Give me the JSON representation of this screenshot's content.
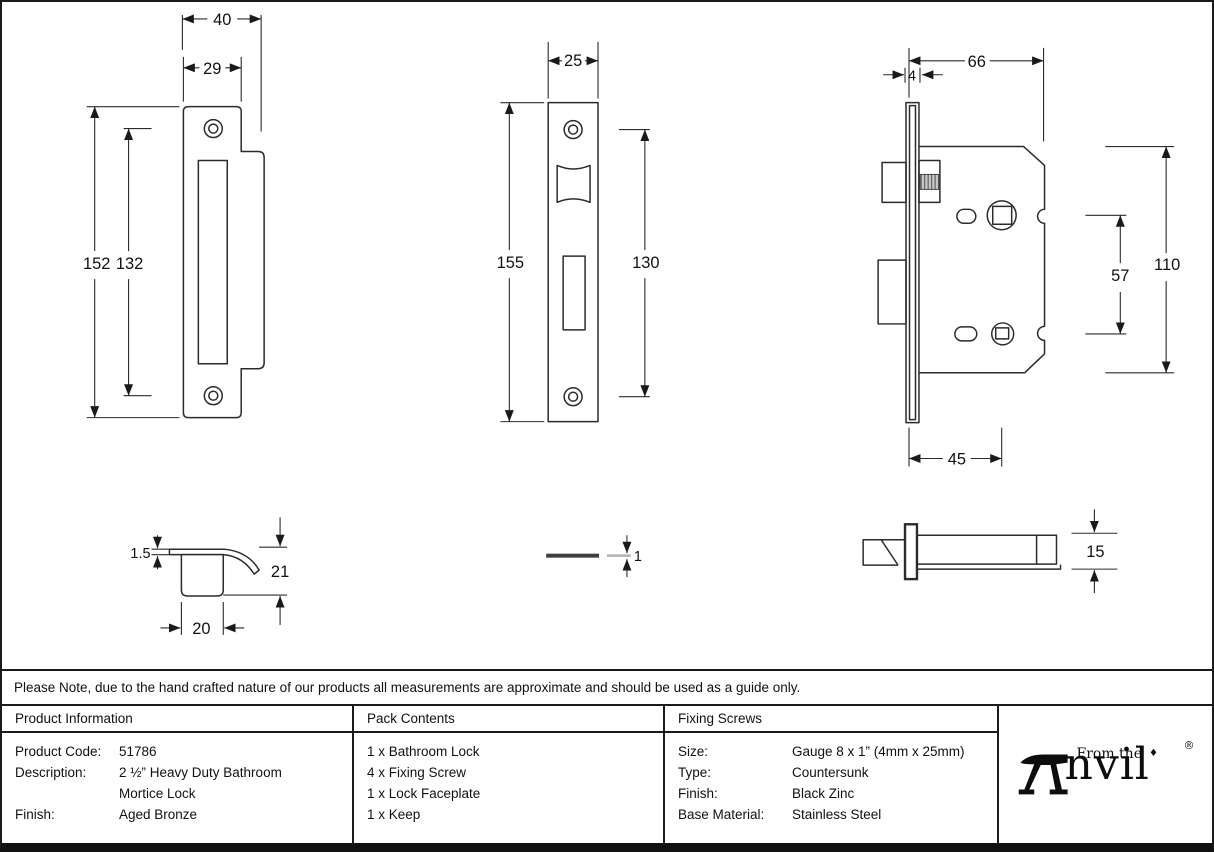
{
  "note": "Please Note, due to the hand crafted nature of our products all measurements are approximate and should be used as a guide only.",
  "table": {
    "product_information": {
      "header": "Product Information",
      "rows": [
        {
          "label": "Product Code:",
          "value": "51786"
        },
        {
          "label": "Description:",
          "value": "2 ½” Heavy Duty Bathroom"
        },
        {
          "label": "",
          "value": "Mortice Lock"
        },
        {
          "label": "Finish:",
          "value": "Aged Bronze"
        }
      ]
    },
    "pack_contents": {
      "header": "Pack Contents",
      "items": [
        "1 x Bathroom Lock",
        "4 x Fixing Screw",
        "1 x Lock Faceplate",
        "1 x Keep"
      ]
    },
    "fixing_screws": {
      "header": "Fixing Screws",
      "rows": [
        {
          "label": "Size:",
          "value": "Gauge 8 x 1” (4mm x 25mm)"
        },
        {
          "label": "Type:",
          "value": "Countersunk"
        },
        {
          "label": "Finish:",
          "value": "Black Zinc"
        },
        {
          "label": "Base Material:",
          "value": "Stainless Steel"
        }
      ]
    }
  },
  "logo": {
    "tagline": "From the",
    "diamond": "♦",
    "brand_suffix": "nvil",
    "registered": "®"
  },
  "dimensions": {
    "keep_front": {
      "width_overall": "40",
      "width_plate": "29",
      "height_overall": "152",
      "hole_spacing": "132"
    },
    "faceplate_front": {
      "width": "25",
      "height": "155",
      "hole_spacing": "130"
    },
    "body_side": {
      "case_width": "66",
      "plate_thickness": "4",
      "case_height": "110",
      "follower_spacing": "57",
      "backset": "45"
    },
    "keep_side": {
      "plate_thickness": "1.5",
      "depth": "21",
      "box_width": "20"
    },
    "faceplate_side": {
      "thickness": "1"
    },
    "body_plan": {
      "thickness": "15"
    }
  }
}
